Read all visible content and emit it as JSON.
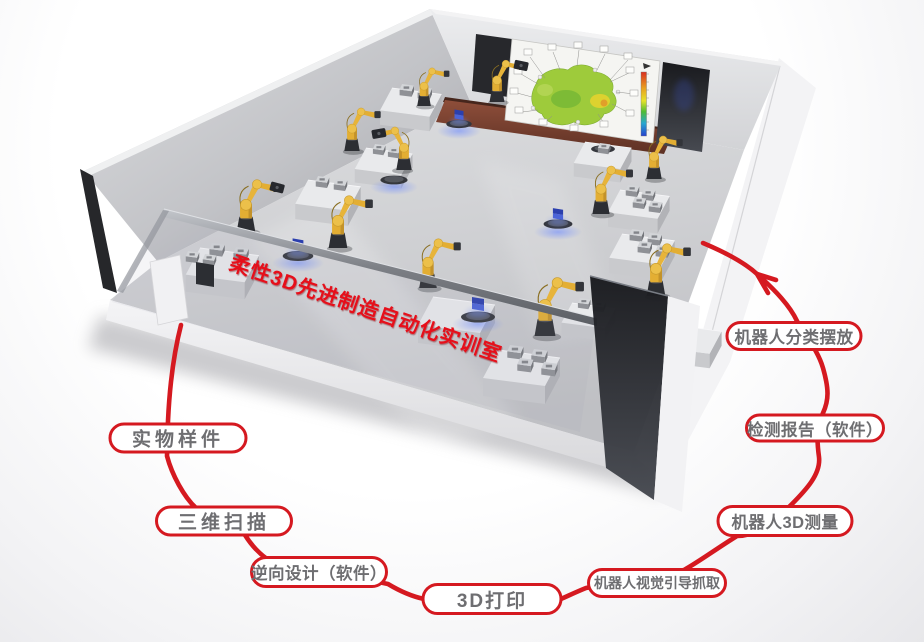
{
  "title": {
    "text": "柔性3D先进制造自动化实训室",
    "color": "#e60f1a"
  },
  "flow": {
    "line_color": "#d51920",
    "direction": "counterclockwise-into-room",
    "labels": [
      {
        "id": "physical-sample",
        "text": "实物样件"
      },
      {
        "id": "three-d-scanning",
        "text": "三维扫描"
      },
      {
        "id": "reverse-design-software",
        "text": "逆向设计（软件）"
      },
      {
        "id": "three-d-printing",
        "text": "3D打印"
      },
      {
        "id": "vision-guided-grasping",
        "text": "机器人视觉引导抓取"
      },
      {
        "id": "robot-3d-measurement",
        "text": "机器人3D测量"
      },
      {
        "id": "inspection-report-software",
        "text": "检测报告（软件）"
      },
      {
        "id": "robot-sorting-placement",
        "text": "机器人分类摆放"
      }
    ]
  },
  "scene": {
    "type": "3d-render-training-room",
    "colors": {
      "robot_yellow": "#e7b43a",
      "wall_grey": "#c9cacd",
      "stage_brown": "#7a4230",
      "screen_white": "#f5f5f2",
      "heatmap_green": "#9ecb3b",
      "glow_blue": "#5f7cf0",
      "accent_red": "#d51920"
    }
  }
}
